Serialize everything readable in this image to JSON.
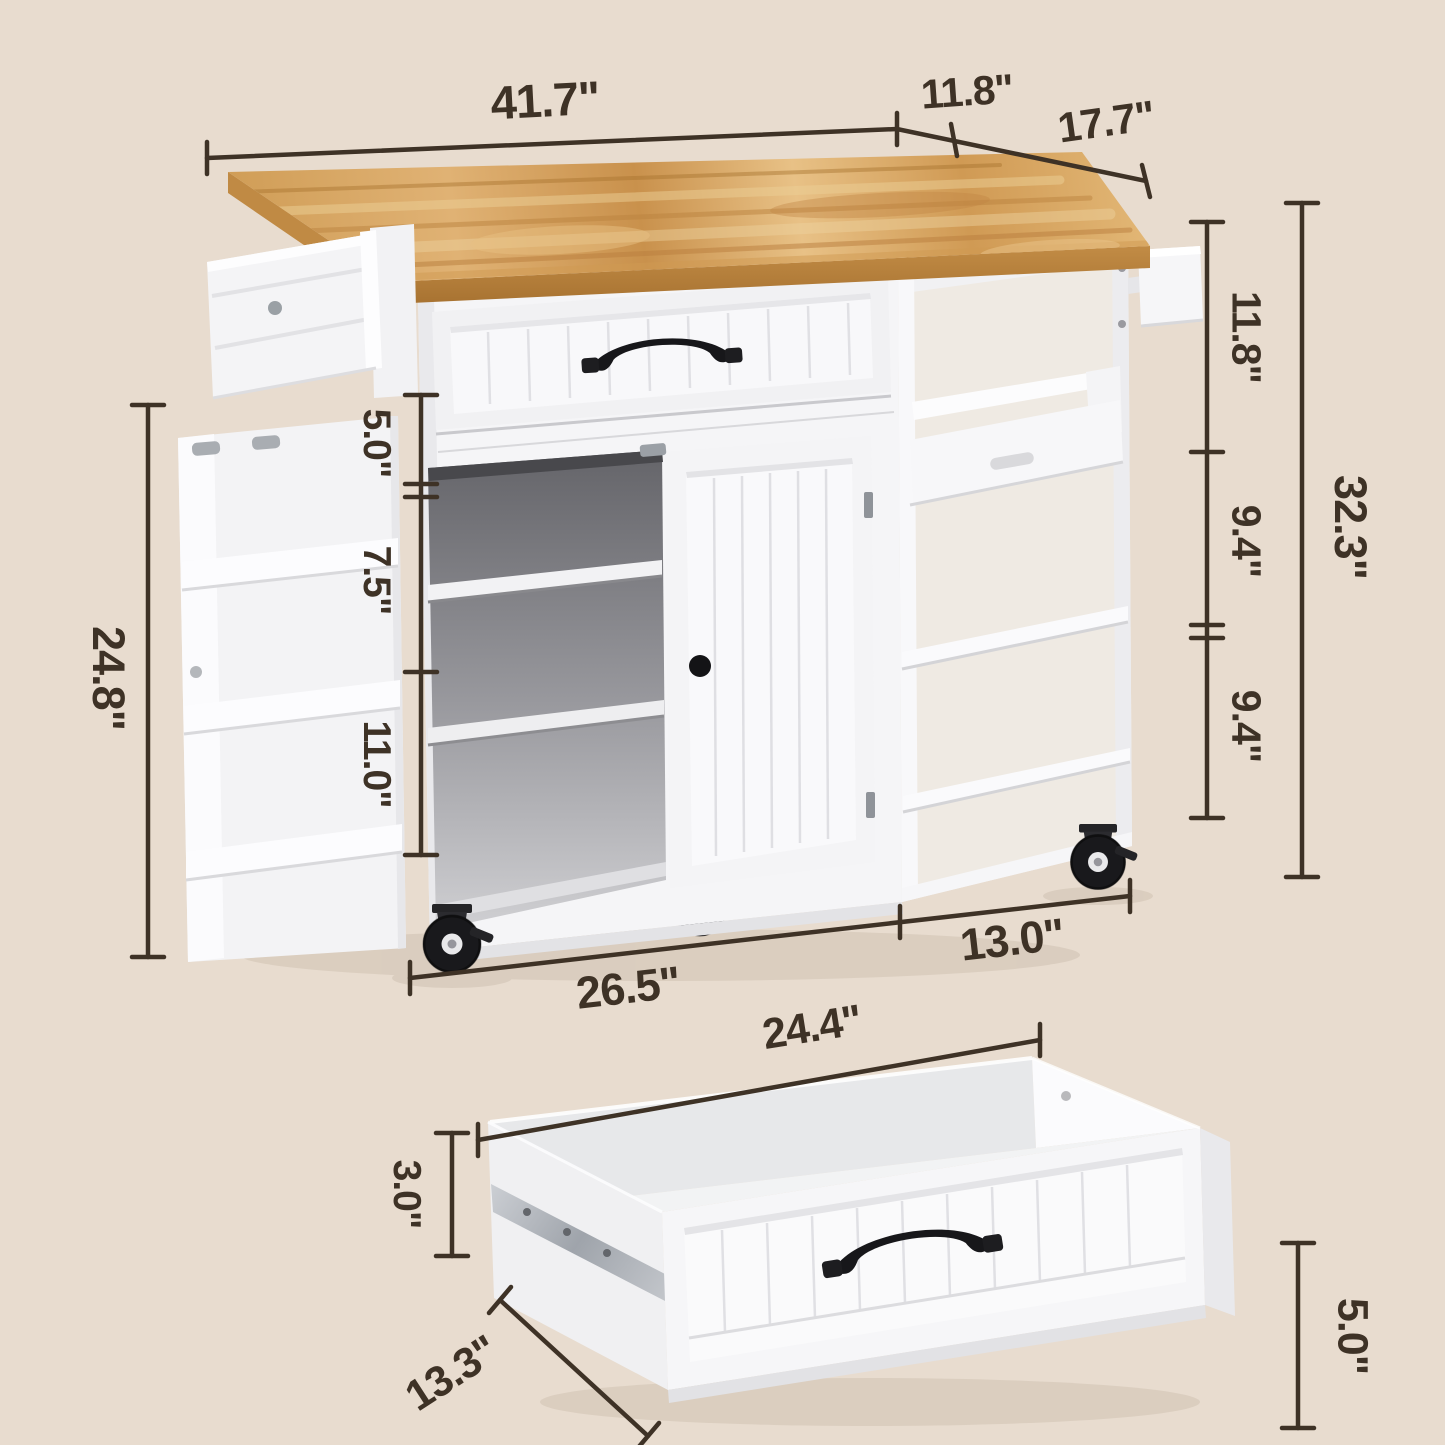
{
  "diagram_title": "kitchen island cart dimensions diagram",
  "colors": {
    "background": "#e8dccf",
    "annotation": "#3e3226",
    "wood_top": "#d4a35e",
    "cabinet_white": "#f5f5f7",
    "hardware_black": "#17171a"
  },
  "dims": {
    "top_width": "41.7\"",
    "drop_leaf_depth": "11.8\"",
    "top_depth": "17.7\"",
    "right_upper": "11.8\"",
    "right_middle": "9.4\"",
    "right_lower": "9.4\"",
    "right_total_height": "32.3\"",
    "left_height": "24.8\"",
    "left_top_section": "5.0\"",
    "left_middle_section": "7.5\"",
    "left_bottom_section": "11.0\"",
    "cabinet_width": "26.5\"",
    "side_unit_width": "13.0\"",
    "drawer_width": "24.4\"",
    "drawer_back_height": "3.0\"",
    "drawer_depth": "13.3\"",
    "drawer_front_height": "5.0\""
  }
}
